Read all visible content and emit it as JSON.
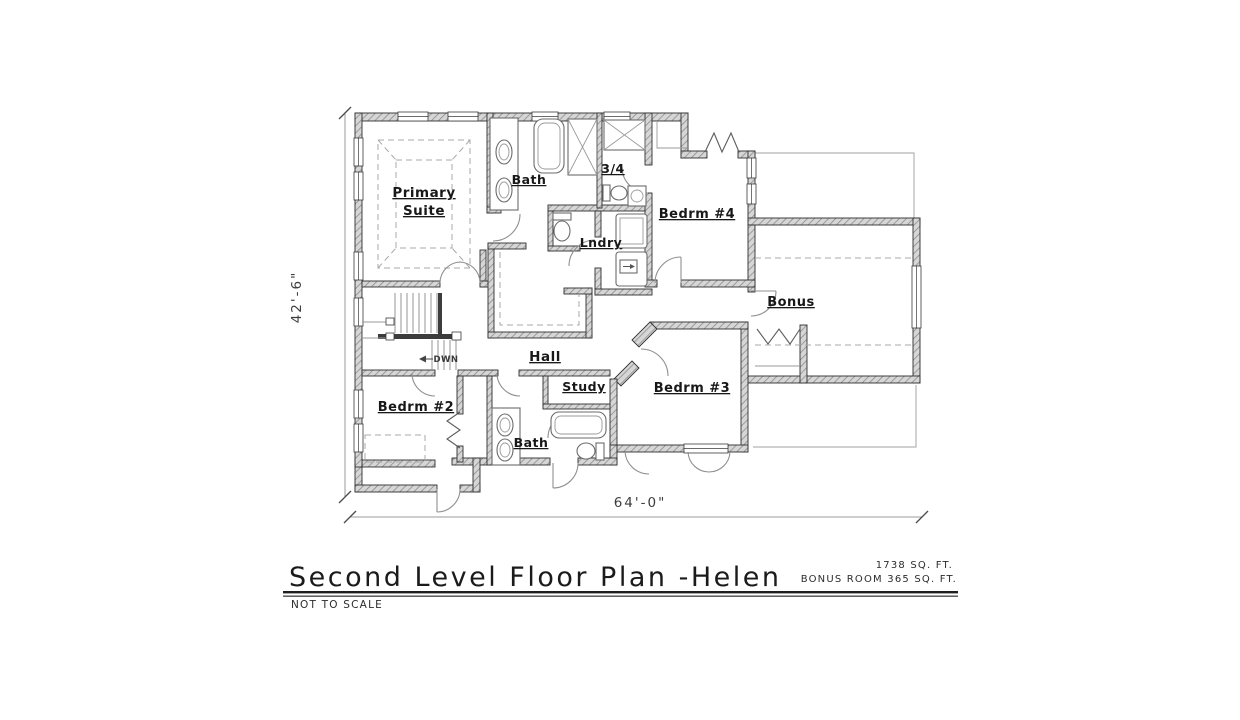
{
  "title_block": {
    "title": "Second Level Floor Plan -Helen",
    "area_main": "1738 SQ. FT.",
    "area_bonus": "BONUS ROOM 365 SQ. FT.",
    "scale_note": "NOT TO SCALE"
  },
  "dimensions": {
    "overall_depth": "42'-6\"",
    "overall_width": "64'-0\""
  },
  "rooms": {
    "primary_suite_line1": "Primary",
    "primary_suite_line2": "Suite",
    "primary_bath": "Bath",
    "three_quarter_bath": "3/4",
    "laundry": "Lndry",
    "bedroom_4": "Bedrm #4",
    "bonus": "Bonus",
    "hall": "Hall",
    "study": "Study",
    "bedroom_3": "Bedrm #3",
    "bedroom_2": "Bedrm #2",
    "bath_2": "Bath",
    "stair_direction": "DWN"
  },
  "colors": {
    "paper": "#ffffff",
    "ink": "#1b1b1b",
    "wall_hatch": "#8c8c8c"
  }
}
